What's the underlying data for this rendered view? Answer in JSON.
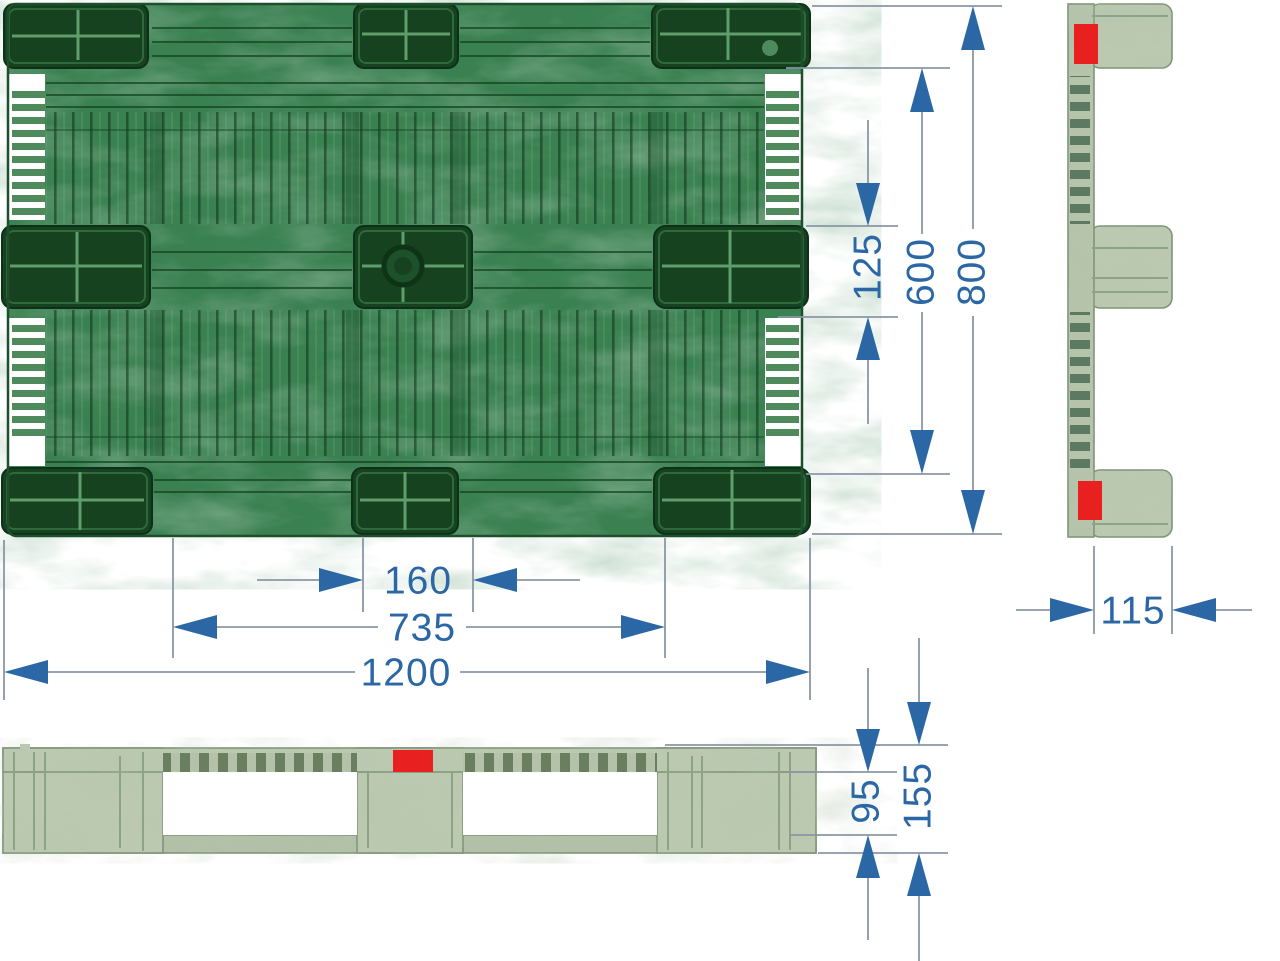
{
  "title": "Plastic pallet technical drawing",
  "dims": {
    "overall_length": "1200",
    "runner_span": "735",
    "center_foot_width": "160",
    "overall_depth": "800",
    "inner_depth": "600",
    "middle_runner_width": "125",
    "foot_depth": "115",
    "opening_height": "95",
    "overall_height": "155"
  },
  "colors": {
    "dimension_blue": "#2b67a5",
    "line_gray": "#8b96a6",
    "marker_red": "#e8201f",
    "pallet_green": "#3a8050",
    "pocket_green": "#16421f",
    "pallet_sage": "#bcc9b1"
  }
}
